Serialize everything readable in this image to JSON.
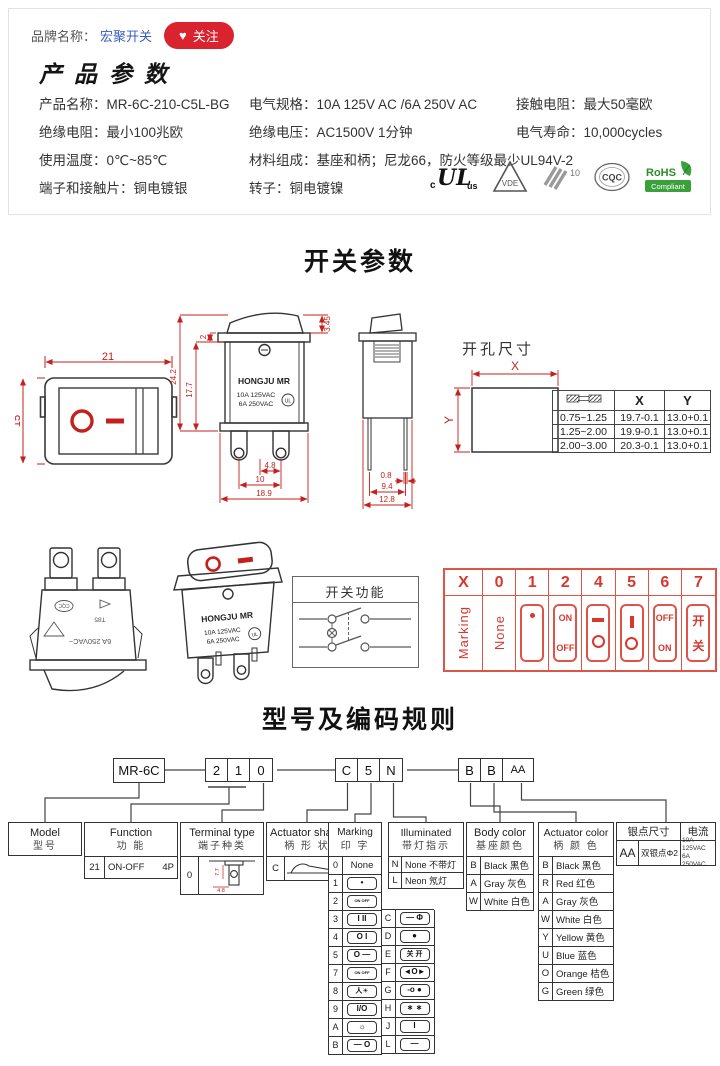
{
  "colors": {
    "accent_red": "#c4201d",
    "strip_red": "#de5548",
    "link_blue": "#3a5dbf",
    "button_red": "#d9232e",
    "rohs_green": "#3aa03a"
  },
  "brand_bar": {
    "label": "品牌名称：",
    "brand": "宏聚开关",
    "heart": "♥",
    "follow": "关注"
  },
  "product": {
    "title": "产品参数",
    "specs": [
      {
        "l": "产品名称：",
        "v": "MR-6C-210-C5L-BG"
      },
      {
        "l": "电气规格：",
        "v": "10A 125V AC /6A 250V AC"
      },
      {
        "l": "接触电阻：",
        "v": "最大50毫欧"
      },
      {
        "l": "绝缘电阻：",
        "v": "最小100兆欧"
      },
      {
        "l": "绝缘电压：",
        "v": "AC1500V 1分钟"
      },
      {
        "l": "电气寿命：",
        "v": "10,000cycles"
      },
      {
        "l": "使用温度：",
        "v": "0℃~85℃"
      },
      {
        "l": "材料组成：",
        "v": "基座和柄；尼龙66，防火等级最少UL94V-2"
      },
      {
        "l": "端子和接触片：",
        "v": "铜电镀银"
      },
      {
        "l": "转子：",
        "v": "铜电镀镍"
      }
    ],
    "certs": {
      "ul_c": "c",
      "ul": "UL",
      "ul_us": "us",
      "vde": "VDE",
      "k10": "10",
      "cqc": "CQC",
      "rohs": "RoHS",
      "rohs_sub": "Compliant"
    }
  },
  "switch_section": {
    "title": "开关参数",
    "front": {
      "w": "21",
      "h": "15"
    },
    "side": {
      "protrude": "3.45",
      "flange": "2",
      "body_h": "17.7",
      "total_h": "24.2",
      "pin_gap": "4.8",
      "pin_span": "10",
      "width": "18.9",
      "brand": "HONGJU MR",
      "rating1": "10A 125VAC",
      "rating2": "6A 250VAC"
    },
    "end": {
      "pin_w": "0.8",
      "pin_span": "9.4",
      "width": "12.8"
    },
    "hole": {
      "title": "开孔尺寸",
      "x": "X",
      "y": "Y"
    },
    "hole_table": {
      "x": "X",
      "y": "Y",
      "rows": [
        [
          "0.75~1.25",
          "19.7-0.1",
          "13.0+0.1"
        ],
        [
          "1.25~2.00",
          "19.9-0.1",
          "13.0+0.1"
        ],
        [
          "2.00~3.00",
          "20.3-0.1",
          "13.0+0.1"
        ]
      ]
    }
  },
  "middle": {
    "illus1": {
      "rating": "6A 250VAC~",
      "t85": "T85",
      "cqc": "CQC"
    },
    "illus2": {
      "brand": "HONGJU MR",
      "rating1": "10A 125VAC",
      "rating2": "6A 250VAC"
    },
    "function_box": {
      "title": "开关功能"
    },
    "strip": {
      "headers": [
        "X",
        "0",
        "1",
        "2",
        "4",
        "5",
        "6",
        "7"
      ],
      "marking": "Marking",
      "none": "None",
      "c1": {
        "glyph": "•"
      },
      "c2": {
        "top": "ON",
        "bottom": "OFF"
      },
      "c4": {
        "top": "—",
        "bottom": "O"
      },
      "c5": {
        "top": "|",
        "bottom": "O"
      },
      "c6": {
        "top": "OFF",
        "bottom": "ON"
      },
      "c7": {
        "top": "开",
        "bottom": "关"
      }
    }
  },
  "coding": {
    "title": "型号及编码规则",
    "model_code": "MR-6C",
    "seg1": [
      "2",
      "1",
      "0"
    ],
    "seg2": [
      "C",
      "5",
      "N"
    ],
    "seg3": [
      "B",
      "B",
      "AA"
    ],
    "model": {
      "en": "Model",
      "cn": "型号"
    },
    "function": {
      "en": "Function",
      "cn": "功 能",
      "code": "21",
      "value": "ON-OFF",
      "poles": "4P"
    },
    "terminal": {
      "en": "Terminal type",
      "cn": "端子种类",
      "code": "0",
      "d1": "7.7",
      "d2": "4.8"
    },
    "shape": {
      "en": "Actuator shape",
      "cn": "柄 形 状",
      "code": "C"
    },
    "marking": {
      "en": "Marking",
      "cn": "印 字",
      "col1": [
        {
          "c": "0",
          "g": "None"
        },
        {
          "c": "1",
          "g": "•"
        },
        {
          "c": "2",
          "g": "ON OFF"
        },
        {
          "c": "3",
          "g": "I II"
        },
        {
          "c": "4",
          "g": "O I"
        },
        {
          "c": "5",
          "g": "O —"
        },
        {
          "c": "7",
          "g": "ON OFF"
        },
        {
          "c": "8",
          "g": "人☀"
        },
        {
          "c": "9",
          "g": "I/O"
        },
        {
          "c": "A",
          "g": "☼"
        },
        {
          "c": "B",
          "g": "— O"
        }
      ],
      "col2": [
        {
          "c": "C",
          "g": "— Φ"
        },
        {
          "c": "D",
          "g": "●"
        },
        {
          "c": "E",
          "g": "关 开"
        },
        {
          "c": "F",
          "g": "◄O►"
        },
        {
          "c": "G",
          "g": "-o ●"
        },
        {
          "c": "H",
          "g": "∗ ∗"
        },
        {
          "c": "J",
          "g": "I"
        },
        {
          "c": "L",
          "g": "—"
        }
      ]
    },
    "illuminated": {
      "en": "Illuminated",
      "cn": "带灯指示",
      "rows": [
        {
          "c": "N",
          "v": "None 不带灯"
        },
        {
          "c": "L",
          "v": "Neon 氖灯"
        }
      ]
    },
    "body_color": {
      "en": "Body color",
      "cn": "基座颜色",
      "rows": [
        {
          "c": "B",
          "v": "Black 黑色"
        },
        {
          "c": "A",
          "v": "Gray 灰色"
        },
        {
          "c": "W",
          "v": "White 白色"
        }
      ]
    },
    "actuator_color": {
      "en": "Actuator color",
      "cn": "柄 颜 色",
      "rows": [
        {
          "c": "B",
          "v": "Black 黑色"
        },
        {
          "c": "R",
          "v": "Red 红色"
        },
        {
          "c": "A",
          "v": "Gray 灰色"
        },
        {
          "c": "W",
          "v": "White 白色"
        },
        {
          "c": "Y",
          "v": "Yellow 黄色"
        },
        {
          "c": "U",
          "v": "Blue 蓝色"
        },
        {
          "c": "O",
          "v": "Orange 桔色"
        },
        {
          "c": "G",
          "v": "Green 绿色"
        }
      ]
    },
    "silver": {
      "h1": "银点尺寸",
      "h2": "电流",
      "code": "AA",
      "desc": "双银点Φ2",
      "cur1": "10A 125VAC",
      "cur2": "6A 250VAC"
    }
  }
}
